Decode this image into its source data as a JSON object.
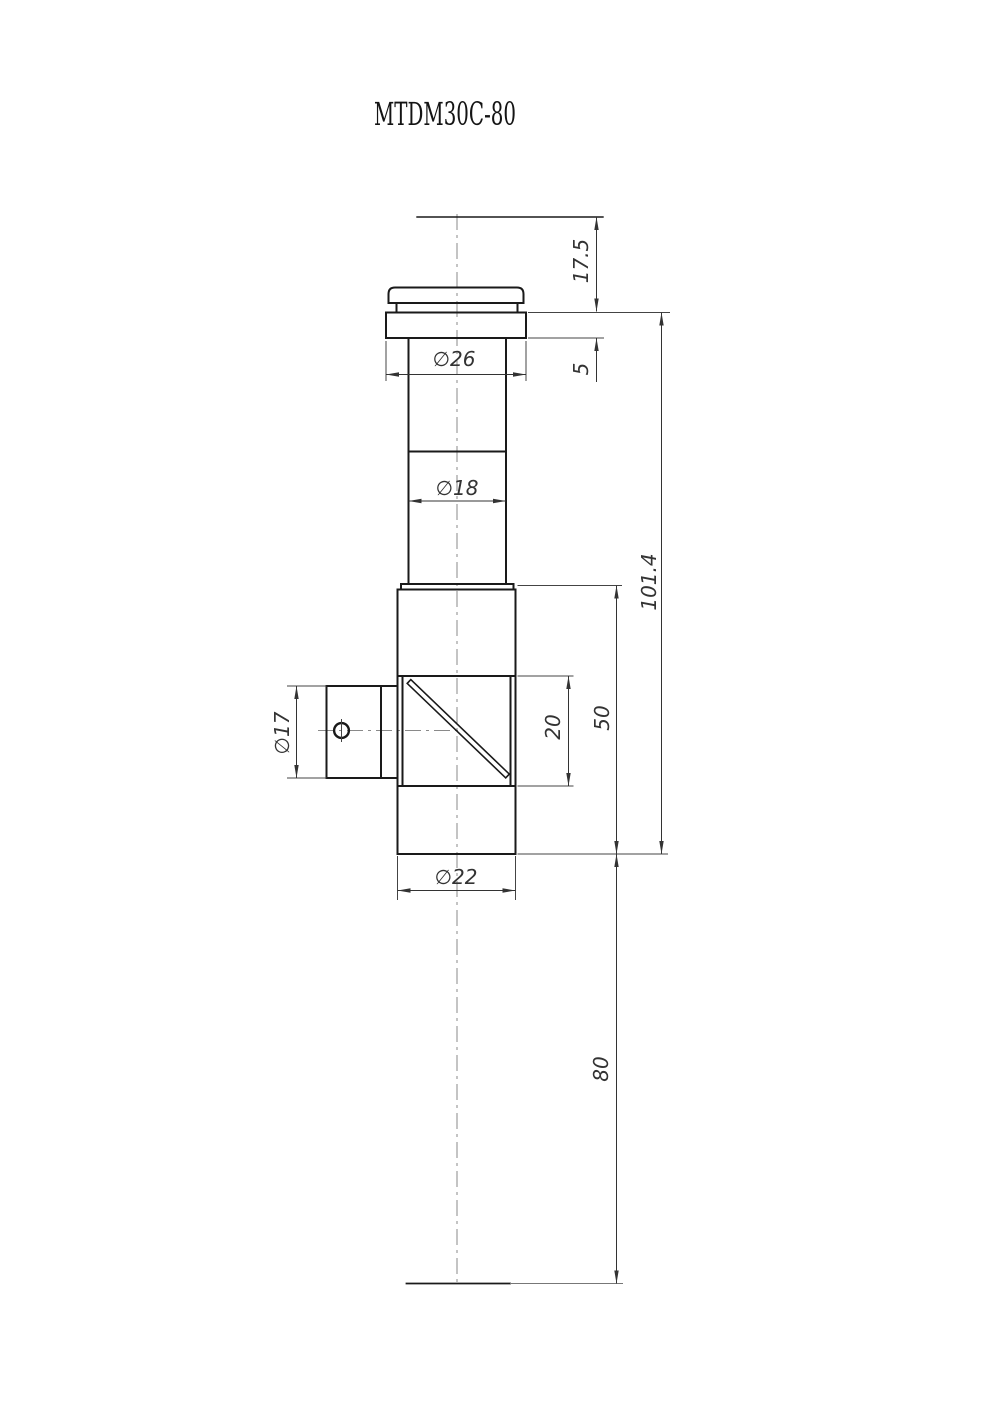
{
  "title": "MTDM30C-80",
  "dimensions": {
    "top_to_flange": "17.5",
    "flange_thickness": "5",
    "flange_diameter": "∅26",
    "tube_diameter": "∅18",
    "overall_length": "101.4",
    "body_length": "50",
    "aperture_length": "20",
    "side_port_diameter": "∅17",
    "body_diameter": "∅22",
    "exit_distance": "80"
  }
}
